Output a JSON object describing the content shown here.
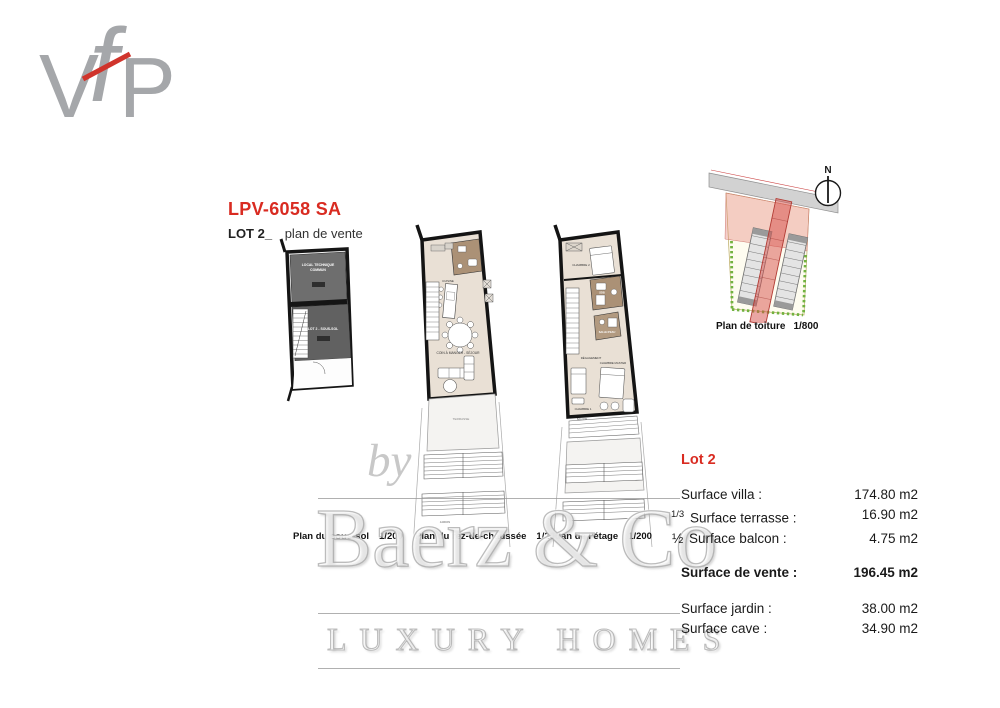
{
  "colors": {
    "accent_red": "#d92b21",
    "logo_gray": "#a5a7aa",
    "logo_slash_red": "#d0342c",
    "floor_beige": "#e9e0d5",
    "wet_room_brown": "#ab9176",
    "basement_gray": "#6a6a6a",
    "site_green": "#71b23f",
    "site_lot_red": "#d64e48",
    "watermark_gray": "#bdbdbd"
  },
  "logo": {
    "v": "V",
    "f": "f",
    "p": "P"
  },
  "header": {
    "reference": "LPV-6058 SA",
    "lot": "LOT 2_",
    "subtitle": "plan de vente"
  },
  "plans": {
    "sous_sol": {
      "caption": "Plan du sous-sol",
      "scale": "1/200",
      "rooms": {
        "technical_1": "LOCAL TECHNIQUE",
        "technical_2": "COMMUN",
        "cellar": "LOT 2 - SOUS-SOL"
      }
    },
    "rdc": {
      "caption": "Plan du rez-de-chaussée",
      "scale": "1/200",
      "rooms": {
        "kitchen": "CUISINE",
        "living": "COIN À MANGER - SÉJOUR",
        "terrace": "TERRASSE",
        "garden": "JARDIN"
      }
    },
    "etage": {
      "caption": "Plan de l'étage",
      "scale": "1/200",
      "rooms": {
        "bedroom2": "CHAMBRE 2",
        "bathroom": "SDB",
        "shower": "SALLE D'EAU",
        "hall": "DÉGAGEMENT",
        "bedroom1": "CHAMBRE 1",
        "master": "CHAMBRE MASTER",
        "balcony": "BALCON"
      }
    },
    "roof": {
      "caption": "Plan de toiture",
      "scale": "1/800",
      "north": "N"
    }
  },
  "lot_info": {
    "title": "Lot 2",
    "rows": [
      {
        "prefix": "",
        "label": "Surface villa :",
        "value": "174.80 m2"
      },
      {
        "prefix": "1/3",
        "label": "Surface terrasse :",
        "value": "16.90 m2"
      },
      {
        "prefix": "½",
        "label": "Surface balcon :",
        "value": "4.75 m2"
      },
      {
        "prefix": "",
        "label": "Surface de vente :",
        "value": "196.45 m2"
      },
      {
        "prefix": "",
        "label": "Surface jardin :",
        "value": "38.00 m2"
      },
      {
        "prefix": "",
        "label": "Surface cave :",
        "value": "34.90 m2"
      }
    ]
  },
  "watermark": {
    "by": "by",
    "brand": "Baerz & Co",
    "tagline": "LUXURY HOMES"
  }
}
